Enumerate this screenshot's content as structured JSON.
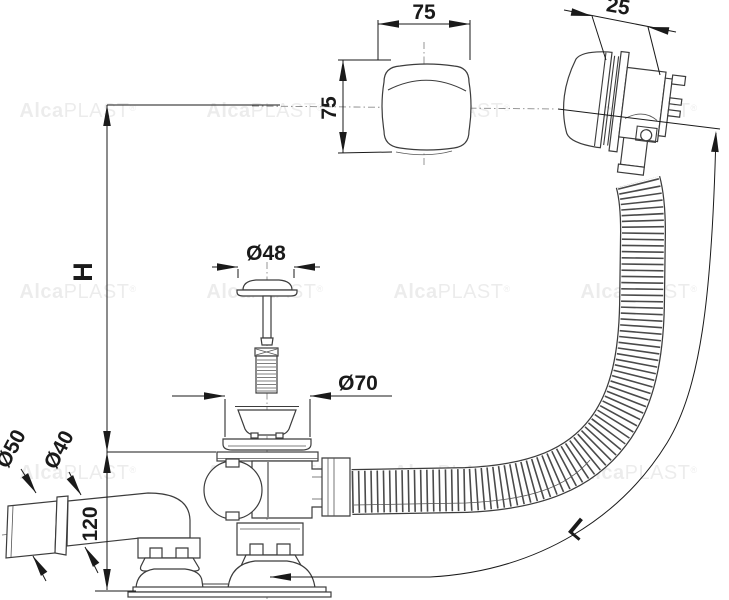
{
  "watermark": {
    "bold": "Alca",
    "light": "PLAST",
    "reg": "®"
  },
  "dimensions": {
    "knob_width": "75",
    "knob_height": "75",
    "overflow_depth": "25",
    "height": "H",
    "plug_diameter": "Ø48",
    "strainer_diameter": "Ø70",
    "outlet_socket_diameter": "Ø50",
    "outlet_pipe_diameter": "Ø40",
    "elbow_height": "120",
    "hose_length": "L"
  }
}
